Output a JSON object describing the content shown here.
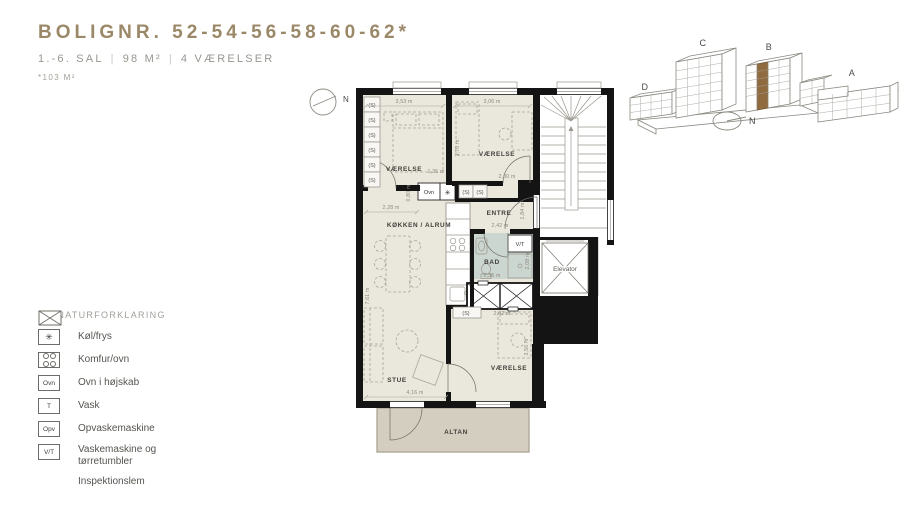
{
  "header": {
    "title": "BOLIGNR. 52-54-56-58-60-62*",
    "subtitle_parts": [
      "1.-6. SAL",
      "98 M²",
      "4 VÆRELSER"
    ],
    "separator": "|",
    "note": "*103 M²"
  },
  "legend": {
    "heading": "SIGNATURFORKLARING",
    "items": [
      {
        "icon": "fridge-snowflake-icon",
        "symbol": "✳",
        "label": "Køl/frys"
      },
      {
        "icon": "cooktop-icon",
        "symbol": "",
        "label": "Komfur/ovn"
      },
      {
        "icon": "oven-box-icon",
        "symbol": "Ovn",
        "label": "Ovn i højskab"
      },
      {
        "icon": "sink-icon",
        "symbol": "T",
        "label": "Vask"
      },
      {
        "icon": "dishwasher-box-icon",
        "symbol": "Opv",
        "label": "Opvaskemaskine"
      },
      {
        "icon": "washer-dryer-box-icon",
        "symbol": "V/T",
        "label": "Vaskemaskine og tørretumbler"
      },
      {
        "icon": "inspection-hatch-icon",
        "symbol": "",
        "label": "Inspektionslem"
      },
      {
        "icon": "shaft-x-icon",
        "symbol": "",
        "label": ""
      }
    ]
  },
  "plan": {
    "north_label": "N",
    "closet_label": "(S)",
    "rooms": {
      "bedroom1": "VÆRELSE",
      "bedroom2": "VÆRELSE",
      "bedroom3": "VÆRELSE",
      "kitchen": "KØKKEN / ALRUM",
      "entry": "ENTRE",
      "bath": "BAD",
      "living": "STUE",
      "balcony": "ALTAN",
      "elevator": "Elevator"
    },
    "fixtures": {
      "oven": "Ovn",
      "fridge": "✳",
      "washer_dryer": "V/T"
    },
    "dims": {
      "bedroom1_width": "3,53 m",
      "bedroom1_bottom": "2,28 m",
      "bedroom1_inner": "1,35 m",
      "bedroom1_door": "0,80 m",
      "bedroom2_width": "3,06 m",
      "bedroom2_depth": "3,70 m",
      "bedroom2_bottom": "2,00 m",
      "entry_width": "2,42 m",
      "entry_door": "1,84 m",
      "bath_width": "2,36 m",
      "bath_depth": "2,08 m",
      "living_depth": "7,61 m",
      "living_width": "4,16 m",
      "bedroom3_width": "2,42 m",
      "bedroom3_depth": "3,56 m"
    }
  },
  "site": {
    "labels": {
      "a": "A",
      "b": "B",
      "c": "C",
      "d": "D"
    },
    "north_label": "N"
  },
  "colors": {
    "accent": "#9b8868",
    "floor": "#eae7dd",
    "bath_floor": "#ccd6d0",
    "balcony_floor": "#d4cec0",
    "wall": "#141414",
    "highlight_units": "#8f6b3f"
  }
}
